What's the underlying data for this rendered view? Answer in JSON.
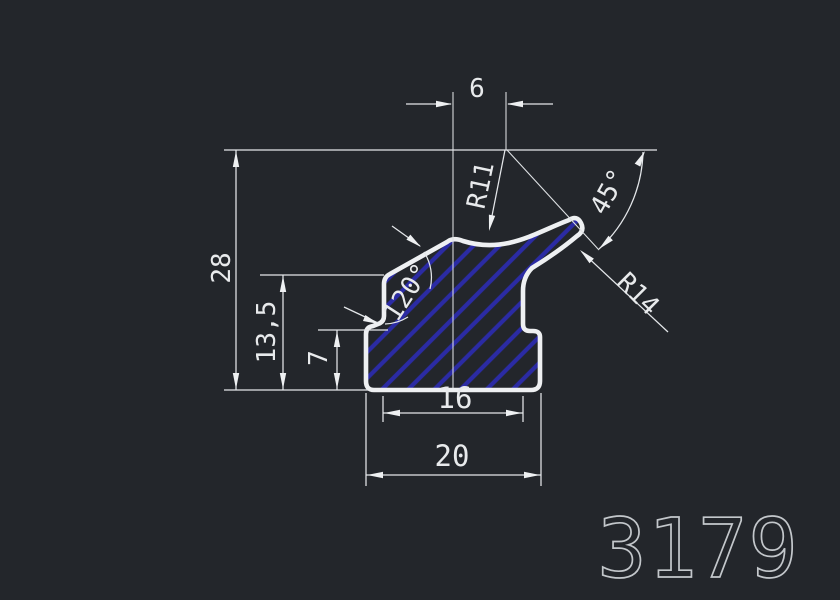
{
  "part_number": "3179",
  "dims": {
    "width_top": "6",
    "height_total": "28",
    "height_shoulder": "13,5",
    "height_base": "7",
    "width_inner": "16",
    "width_base": "20"
  },
  "annotations": {
    "radius_crest": "R11",
    "angle_nose": "45°",
    "radius_nose": "R14",
    "angle_shoulder": "120°"
  },
  "colors": {
    "background": "#23262b",
    "dimension_lines": "#e4e7ea",
    "profile_outline": "#eef0f2",
    "hatch_blue": "#2b2baf",
    "part_number_gray": "#c3c7cb"
  }
}
